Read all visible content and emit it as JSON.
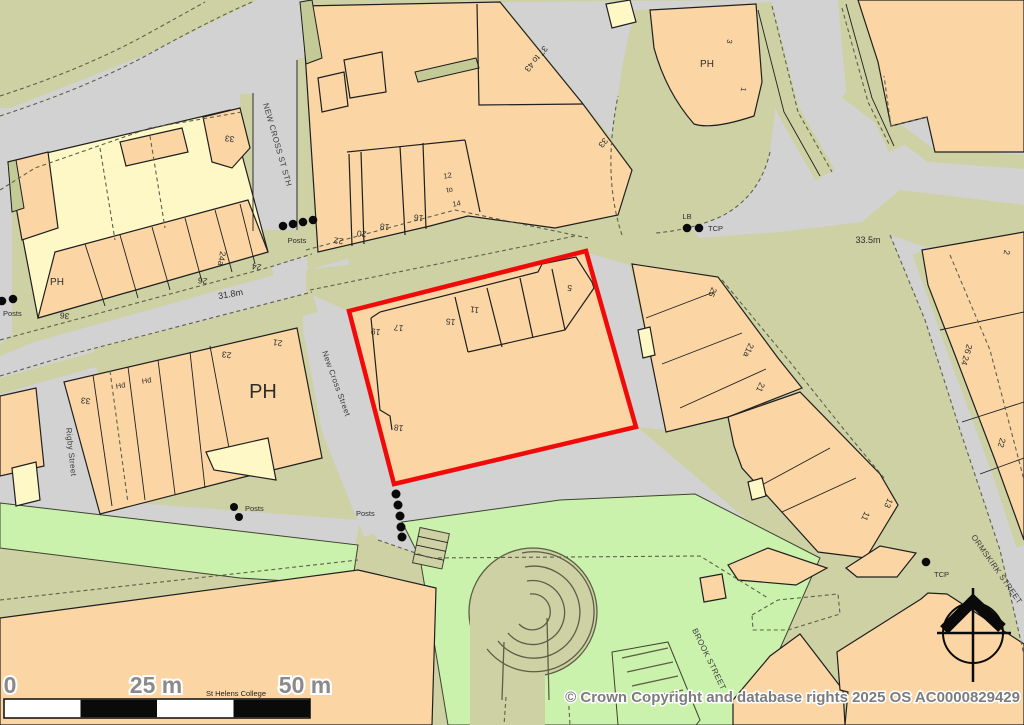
{
  "map": {
    "streets": {
      "new_cross_st_sth": "NEW CROSS ST STH",
      "new_cross_street": "New Cross Street",
      "rigby_street": "Rigby Street",
      "ormskirk_street": "ORMSKIRK STREET",
      "brook_street": "BROOK STREET"
    },
    "labels": {
      "posts": "Posts",
      "tcp": "TCP",
      "lb": "LB",
      "ph": "PH",
      "hd": "Hd",
      "st_helens_college": "St Helens College"
    },
    "heights": {
      "road_a": "31.8m",
      "road_b": "33.5m"
    },
    "numbers": {
      "b33": "33",
      "b24a": "24a",
      "b24": "24",
      "b26": "26",
      "b36": "36",
      "b22": "22",
      "b20": "20",
      "b18": "18",
      "b16": "16",
      "b12": "12",
      "bto": "to",
      "b14": "14",
      "b37to43": "37 to 43",
      "b3": "3",
      "b1": "1",
      "b2": "2",
      "b21": "21",
      "b23": "23",
      "b19": "19",
      "b17": "17",
      "b15": "15",
      "b11": "11",
      "b5": "5",
      "b25": "25",
      "b21a": "21a",
      "b13": "13",
      "b26_24": "26 24"
    },
    "scale_bar": {
      "start": "0",
      "mid": "25 m",
      "end": "50 m"
    },
    "copyright": "© Crown Copyright and database rights 2025 OS AC0000829429",
    "colors": {
      "building": "#FBD6A4",
      "building_pale": "#FDF8C6",
      "road": "#D2D2D2",
      "verge": "#CDD1A3",
      "grass": "#CBF2AC",
      "plot_outline": "#F00A0A"
    }
  }
}
